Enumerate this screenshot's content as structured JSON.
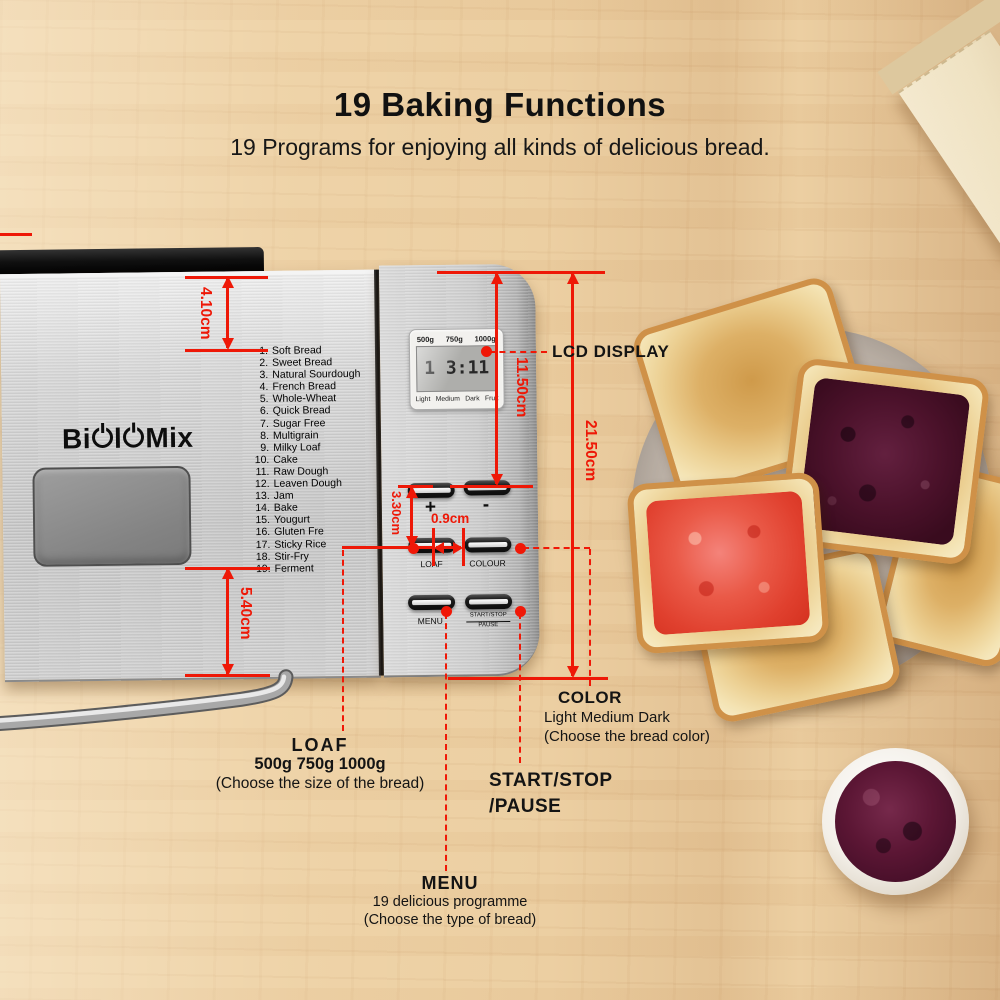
{
  "header": {
    "title": "19 Baking Functions",
    "subtitle": "19 Programs for enjoying all kinds of delicious bread."
  },
  "machine": {
    "brand": "BioloMix",
    "programs": [
      {
        "n": "1.",
        "label": "Soft Bread"
      },
      {
        "n": "2.",
        "label": "Sweet Bread"
      },
      {
        "n": "3.",
        "label": "Natural Sourdough"
      },
      {
        "n": "4.",
        "label": "French Bread"
      },
      {
        "n": "5.",
        "label": "Whole-Wheat"
      },
      {
        "n": "6.",
        "label": "Quick Bread"
      },
      {
        "n": "7.",
        "label": "Sugar Free"
      },
      {
        "n": "8.",
        "label": "Multigrain"
      },
      {
        "n": "9.",
        "label": "Milky Loaf"
      },
      {
        "n": "10.",
        "label": "Cake"
      },
      {
        "n": "11.",
        "label": "Raw Dough"
      },
      {
        "n": "12.",
        "label": "Leaven Dough"
      },
      {
        "n": "13.",
        "label": "Jam"
      },
      {
        "n": "14.",
        "label": "Bake"
      },
      {
        "n": "15.",
        "label": "Yougurt"
      },
      {
        "n": "16.",
        "label": "Gluten Fre"
      },
      {
        "n": "17.",
        "label": "Sticky Rice"
      },
      {
        "n": "18.",
        "label": "Stir-Fry"
      },
      {
        "n": "19.",
        "label": "Ferment"
      }
    ],
    "lcd": {
      "weights": [
        "500g",
        "750g",
        "1000g"
      ],
      "display": "1 3:11",
      "shades": [
        "Light",
        "Medium",
        "Dark",
        "Fruit"
      ]
    },
    "buttons": {
      "plus": "+",
      "minus": "-",
      "loaf": "LOAF",
      "colour": "COLOUR",
      "menu": "MENU",
      "start_stop": "START/STOP",
      "pause": "PAUSE"
    }
  },
  "measurements": {
    "m410": "4.10cm",
    "m1150": "11.50cm",
    "m2150": "21.50cm",
    "m330": "3.30cm",
    "m09": "0.9cm",
    "m540": "5.40cm"
  },
  "callouts": {
    "lcd": {
      "title": "LCD DISPLAY"
    },
    "color": {
      "title": "COLOR",
      "line1": "Light Medium Dark",
      "line2": "(Choose the  bread color)"
    },
    "loaf": {
      "title": "LOAF",
      "line1": "500g  750g 1000g",
      "line2": "(Choose the size of the bread)"
    },
    "start": {
      "title": "START/STOP",
      "line1": "/PAUSE"
    },
    "menu": {
      "title": "MENU",
      "line1": "19 delicious programme",
      "line2": "(Choose the type of bread)"
    }
  },
  "colors": {
    "annotation_red": "#ee1807",
    "machine_silver": "#cfcfcf",
    "lcd_screen": "#aeaeab",
    "jam_red": "#e0402e",
    "jam_dark": "#4c122b",
    "wood": "#eccfa2"
  }
}
